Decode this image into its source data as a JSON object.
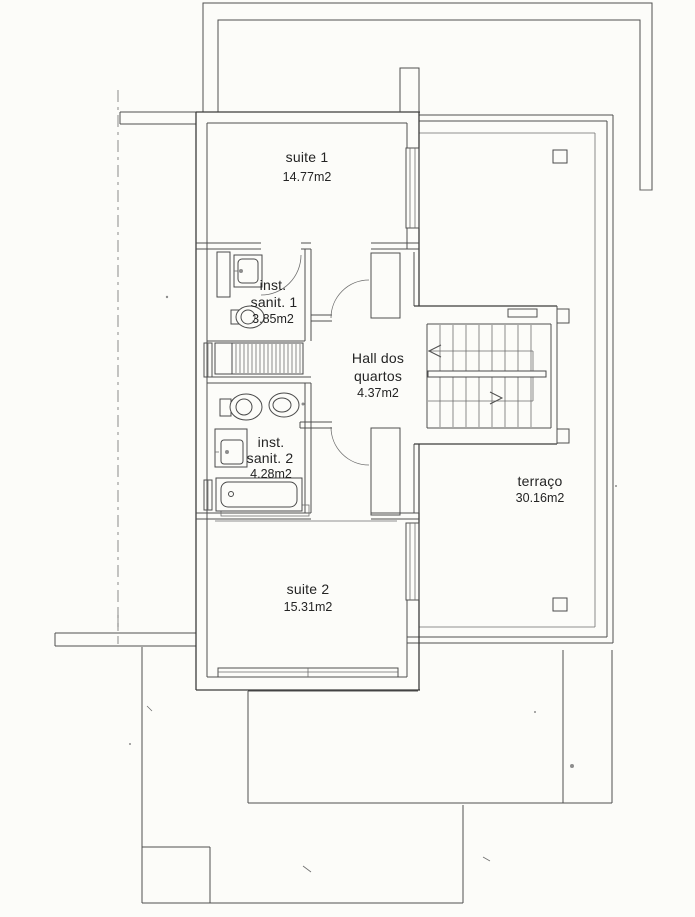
{
  "plan": {
    "rooms": {
      "suite1": {
        "name": "suite 1",
        "area": "14.77m2"
      },
      "sanit1": {
        "line1": "inst.",
        "line2": "sanit. 1",
        "area": "3.85m2"
      },
      "hall": {
        "line1": "Hall dos",
        "line2": "quartos",
        "area": "4.37m2"
      },
      "sanit2": {
        "line1": "inst.",
        "line2": "sanit. 2",
        "area": "4.28m2"
      },
      "suite2": {
        "name": "suite 2",
        "area": "15.31m2"
      },
      "terraco": {
        "name": "terraço",
        "area": "30.16m2"
      }
    },
    "symbols": {
      "washbasin_1": "washbasin",
      "toilet_1": "toilet",
      "shower_1": "shower-hatched",
      "bidet_1": "bidet",
      "toilet_2": "toilet",
      "washbasin_2": "washbasin",
      "bathtub_1": "bathtub",
      "wardrobe_1": "wardrobe",
      "staircase": "staircase-with-up-down-arrows",
      "columns": "terrace-columns",
      "windows": "double-line-window",
      "doors": "quarter-arc-door-swing",
      "boundary": "dash-dot-property-line"
    },
    "colors": {
      "paper": "#fcfcf9",
      "wall": "#3c3c3c",
      "line": "#4f4f4f",
      "text": "#242424"
    }
  }
}
